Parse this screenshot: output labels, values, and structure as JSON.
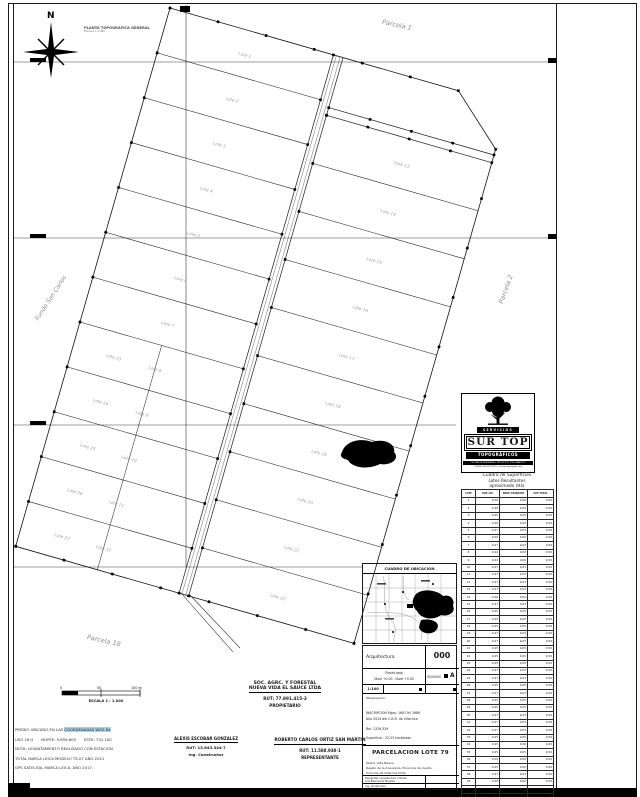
{
  "header": {
    "title": "PLANTA TOPOGRÁFICA GENERAL",
    "subtitle": "ESCALA 1:1.000",
    "north_label": "N"
  },
  "drawing": {
    "labels": {
      "parcela_1": "Parcela 1",
      "parcela_2": "Parcela 2",
      "parcela_18": "Parcela 18",
      "fundo": "Fundo San Carlos"
    },
    "lot_label_prefix": "Lote",
    "left_strips": 12,
    "right_strips": 10,
    "lot_label_color": "#9aa0a6"
  },
  "scalebar": {
    "zero": "0",
    "mid": "50",
    "end": "100 m",
    "label": "ESCALA 1 : 1.000"
  },
  "notes": {
    "line1_prefix": "PREDIO UBICADO EN LAS ",
    "line1_highlight": "COORDENADAS WGS 84",
    "line2a": "USO 18 H",
    "line2b": "NORTE: 5.659.600",
    "line2c": "ESTE: 732.100",
    "line3": "NOTA: LEVANTAMIENTO REALIZADO CON ESTACION",
    "line4": "TOTAL MARCA LEICA MODELO TS-07 AÑO 2021",
    "line5": "GPS SATELITAL  MARCA LEICA. AÑO 2017.",
    "highlight_color": "#a9d0e5"
  },
  "owner": {
    "company1": "SOC. AGRC. Y FORESTAL",
    "company2": "NUEVA VIDA EL SAUCE LTDA",
    "rut": "RUT: 77.891.415-3",
    "role": "PROPIETARIO"
  },
  "signers": [
    {
      "name": "ALEXIS  ESCOBAR  GONZALEZ",
      "rut": "RUT: 13.843.344-7",
      "role": "Ing. Constructor"
    },
    {
      "name": "ROBERTO CARLOS ORTIZ SAN MARTIN",
      "rut": "RUT: 11.588.938-1",
      "role": "REPRESENTANTE"
    }
  ],
  "ubicacion": {
    "title": "CUADRO DE UBICACION"
  },
  "logo": {
    "servicios": "SERVICIOS",
    "name": "SUR TOP",
    "topograficos": "TOPOGRÁFICOS",
    "line1": "OFICINA DE INGENIERIA Y PROYECTOS TOPOGRAFICOS",
    "line2": "CORREO ELECTRONICO: surtop.ltda@gmail.com"
  },
  "surface_table": {
    "title1": "Cuadro de Superficies",
    "title2": "Lotes Resultantes",
    "title3": "aproximado (Há)",
    "headers": [
      "LOTE",
      "SUP. útil",
      "SERV. TRANSITO",
      "SUP TOTAL"
    ],
    "rows": [
      [
        "1",
        "0.50",
        "0.06",
        "0.56"
      ],
      [
        "2",
        "0.48",
        "0.02",
        "0.50"
      ],
      [
        "3",
        "0.45",
        "0.05",
        "0.50"
      ],
      [
        "4",
        "0.46",
        "0.04",
        "0.50"
      ],
      [
        "5",
        "0.47",
        "0.03",
        "0.50"
      ],
      [
        "6",
        "0.50",
        "0.00",
        "0.50"
      ],
      [
        "7",
        "0.47",
        "0.03",
        "0.50"
      ],
      [
        "8",
        "0.44",
        "0.06",
        "0.50"
      ],
      [
        "9",
        "0.44",
        "0.06",
        "0.50"
      ],
      [
        "10",
        "0.47",
        "0.03",
        "0.50"
      ],
      [
        "11",
        "0.47",
        "0.03",
        "0.50"
      ],
      [
        "12",
        "0.47",
        "0.03",
        "0.50"
      ],
      [
        "13",
        "0.47",
        "0.03",
        "0.50"
      ],
      [
        "14",
        "0.48",
        "0.02",
        "0.50"
      ],
      [
        "15",
        "0.47",
        "0.03",
        "0.50"
      ],
      [
        "16",
        "0.45",
        "0.05",
        "0.50"
      ],
      [
        "17",
        "0.45",
        "0.05",
        "0.50"
      ],
      [
        "18",
        "0.45",
        "0.05",
        "0.50"
      ],
      [
        "19",
        "0.47",
        "0.03",
        "0.50"
      ],
      [
        "20",
        "0.47",
        "0.03",
        "0.50"
      ],
      [
        "21",
        "0.45",
        "0.05",
        "0.50"
      ],
      [
        "22",
        "0.45",
        "0.05",
        "0.50"
      ],
      [
        "23",
        "0.45",
        "0.05",
        "0.50"
      ],
      [
        "24",
        "0.47",
        "0.03",
        "0.50"
      ],
      [
        "25",
        "0.47",
        "0.03",
        "0.50"
      ],
      [
        "26",
        "0.45",
        "0.05",
        "0.50"
      ],
      [
        "27",
        "0.47",
        "0.03",
        "0.50"
      ],
      [
        "28",
        "0.45",
        "0.05",
        "0.50"
      ],
      [
        "29",
        "0.45",
        "0.05",
        "0.50"
      ],
      [
        "30",
        "0.47",
        "0.03",
        "0.50"
      ],
      [
        "31",
        "0.47",
        "0.03",
        "0.50"
      ],
      [
        "32",
        "0.47",
        "0.03",
        "0.50"
      ],
      [
        "33",
        "0.45",
        "0.05",
        "0.50"
      ],
      [
        "34",
        "0.45",
        "0.00",
        "0.45"
      ],
      [
        "35",
        "0.45",
        "0.05",
        "0.50"
      ],
      [
        "36",
        "0.50",
        "0.00",
        "0.50"
      ],
      [
        "37",
        "0.45",
        "0.05",
        "0.50"
      ],
      [
        "38",
        "0.47",
        "0.03",
        "0.50"
      ],
      [
        "39",
        "0.48",
        "0.02",
        "0.50"
      ],
      [
        "40",
        "0.47",
        "0.03",
        "0.50"
      ],
      [
        "41",
        "0.45",
        "0.05",
        "0.50"
      ],
      [
        "42",
        "0.47",
        "0.03",
        "0.50"
      ],
      [
        "43",
        "0.48",
        "0.02",
        "0.50"
      ],
      [
        "44",
        "0.48",
        "0.02",
        "0.50"
      ]
    ],
    "total": [
      "TOTAL HA",
      "20.96",
      "1.07",
      "22.03"
    ]
  },
  "titleblock": {
    "discipline": "Arquitectura",
    "plan_number": "000",
    "plano": "Planta baja",
    "nivel": "Nivel +0.00 - Nivel +0.00",
    "fecha": "00/00/00",
    "rev": "A",
    "escala": "1:100",
    "observacion_label": "Observación:",
    "inscripcion1": "INSCRIPCION   Fojas: 1691  Nº 1689",
    "inscripcion2": "Año 2024 del C.B.R. de Villarrica",
    "rol": "Rol: 1339-329",
    "superficie": "Superficie : 22,03 hectáreas",
    "project": "PARCELACION LOTE 79",
    "sector": "Sector Vida Nueva",
    "region": "Región de la Araucanía, Provincia de Cautín,",
    "comuna": "Comuna de Villarrica,Chile",
    "credit1_label": "Topografía / Arquitectura / Diseño",
    "credit1_name": "Luis Raymundo Morales",
    "credit2_label": "Ing. Constructor",
    "credit2_name": "Alexis Escobar Gonzalez",
    "number_color": "#1d1d4f"
  }
}
